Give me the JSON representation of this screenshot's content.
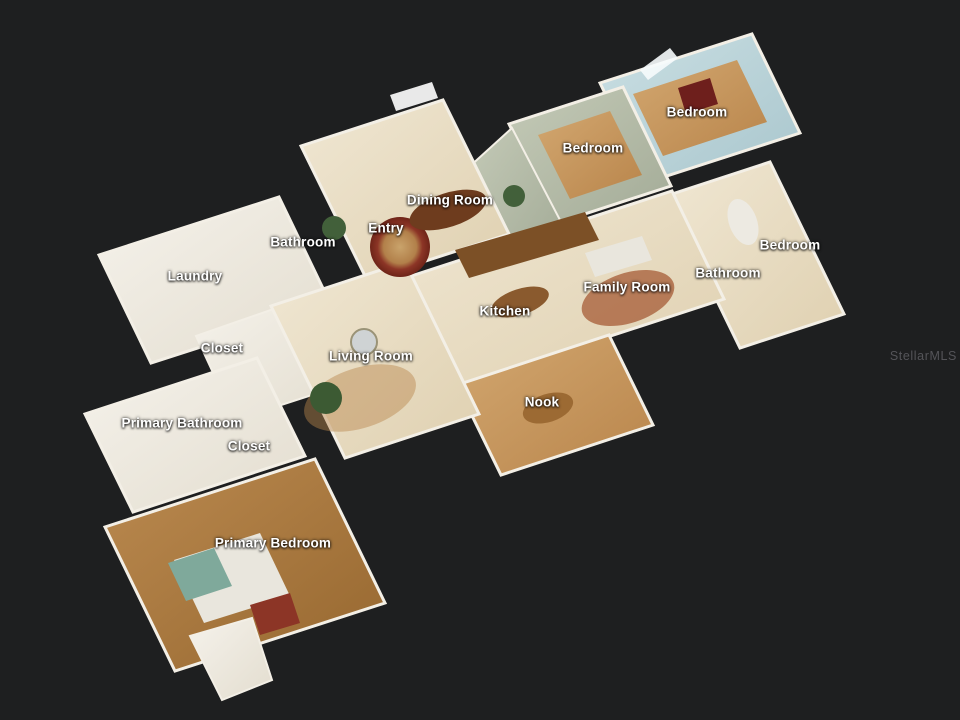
{
  "scene": {
    "watermark": "StellarMLS",
    "view": "3D dollhouse floor plan"
  },
  "colors": {
    "background": "#1e1f20",
    "label_text": "#ffffff",
    "watermark_text": "#57575c",
    "wall_white": "#f3efe6",
    "cream_floor": "#e8dcc2",
    "wood_light": "#c79a62",
    "wood_dark": "#a5763e",
    "wall_blue": "#bdd4d9",
    "wall_sage": "#b7bfac",
    "rug_red": "#8c3526",
    "plant_green": "#42603a",
    "counter_brown": "#7c5026",
    "bed_linen": "#e9e6dd",
    "teal_accent": "#7fa99b"
  },
  "floorplan": {
    "room_labels": [
      {
        "label": "Bedroom",
        "x": 697,
        "y": 112
      },
      {
        "label": "Bedroom",
        "x": 593,
        "y": 148
      },
      {
        "label": "Dining Room",
        "x": 450,
        "y": 200
      },
      {
        "label": "Entry",
        "x": 386,
        "y": 228
      },
      {
        "label": "Bathroom",
        "x": 303,
        "y": 242
      },
      {
        "label": "Bedroom",
        "x": 790,
        "y": 245
      },
      {
        "label": "Bathroom",
        "x": 728,
        "y": 273
      },
      {
        "label": "Laundry",
        "x": 195,
        "y": 276
      },
      {
        "label": "Family Room",
        "x": 627,
        "y": 287
      },
      {
        "label": "Kitchen",
        "x": 505,
        "y": 311
      },
      {
        "label": "Closet",
        "x": 222,
        "y": 348
      },
      {
        "label": "Living Room",
        "x": 371,
        "y": 356
      },
      {
        "label": "Nook",
        "x": 542,
        "y": 402
      },
      {
        "label": "Primary Bathroom",
        "x": 182,
        "y": 423
      },
      {
        "label": "Closet",
        "x": 249,
        "y": 446
      },
      {
        "label": "Primary Bedroom",
        "x": 273,
        "y": 543
      }
    ]
  }
}
